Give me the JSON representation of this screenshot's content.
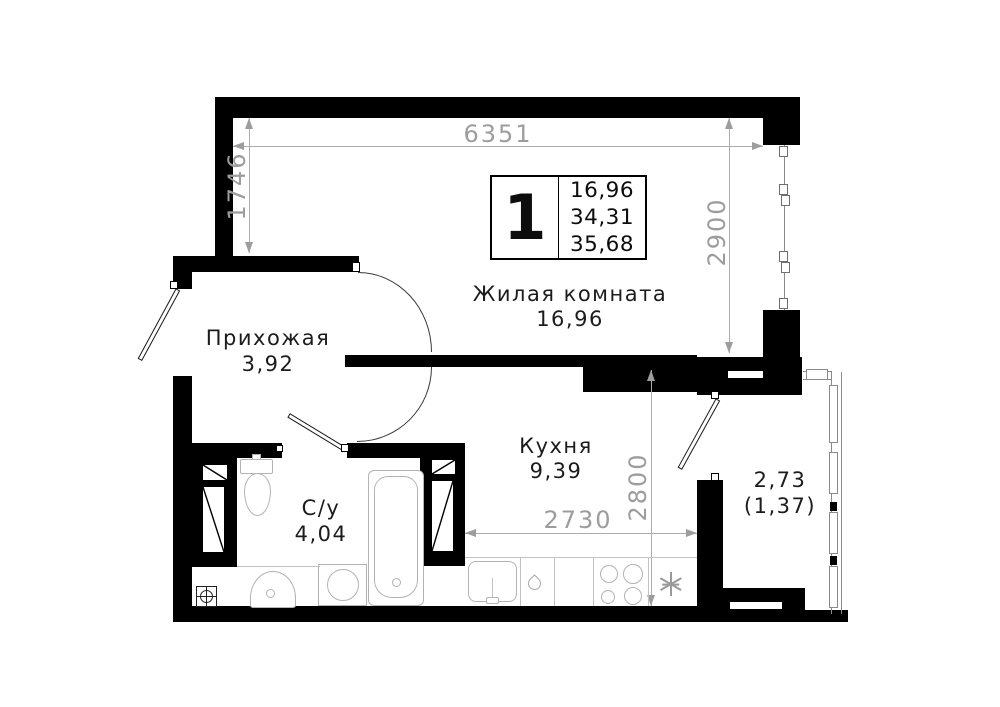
{
  "title": "Floor plan of 1-room apartment",
  "info_box": {
    "rooms_count": "1",
    "living_area": "16,96",
    "area_without_balcony": "34,31",
    "total_area": "35,68"
  },
  "rooms": {
    "living": {
      "name": "Жилая комната",
      "area": "16,96"
    },
    "hallway": {
      "name": "Прихожая",
      "area": "3,92"
    },
    "kitchen": {
      "name": "Кухня",
      "area": "9,39"
    },
    "bathroom": {
      "name": "С/у",
      "area": "4,04"
    },
    "balcony": {
      "area": "2,73",
      "area_reduced": "(1,37)"
    }
  },
  "dimensions": {
    "top_width_mm": "6351",
    "left_height_mm": "1746",
    "living_height_mm": "2900",
    "kitchen_height_mm": "2800",
    "kitchen_width_mm": "2730"
  },
  "colors": {
    "walls": "#000000",
    "dimensions": "#9d9d9d",
    "labels": "#1c1c1c",
    "fixtures": "#b3b3b3",
    "background": "#ffffff"
  },
  "fixtures": [
    "toilet",
    "bathtub",
    "washing-machine",
    "wash-basin",
    "floor-drain",
    "ventilation-shaft",
    "kitchen-sink",
    "stove-burners",
    "fridge-snowflake"
  ]
}
